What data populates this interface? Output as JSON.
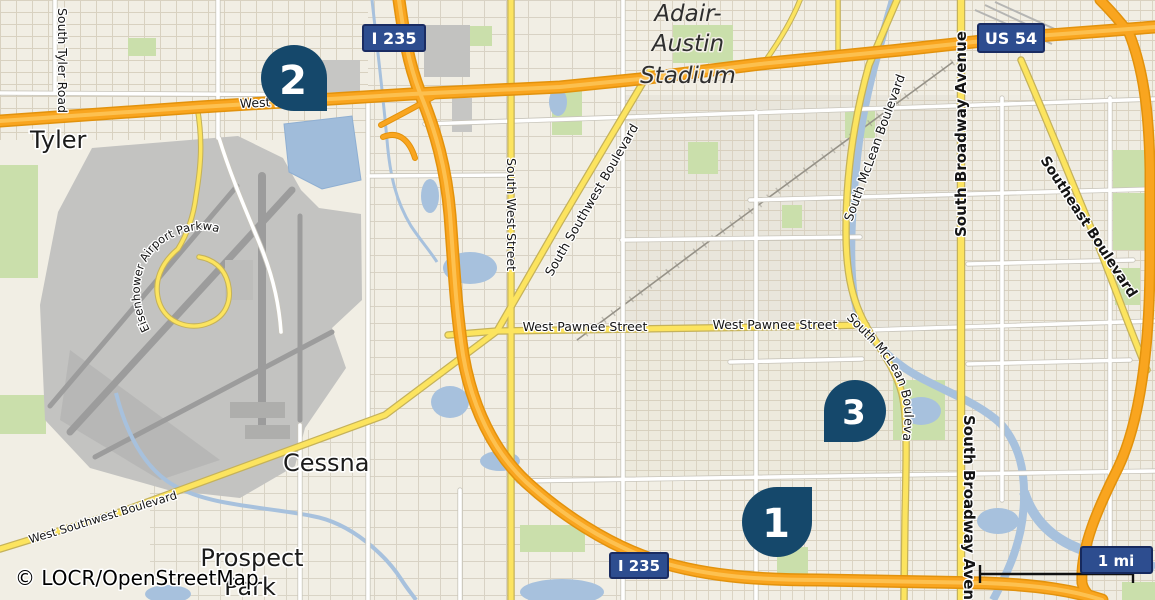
{
  "map": {
    "attribution": "© LOCR/OpenStreetMap",
    "scale_bar": {
      "label": "1 mi"
    },
    "colors": {
      "marker": "#15486b",
      "shield": "#2d4d8f",
      "shield_border": "#1a2c62",
      "motorway": "#f9a51f",
      "primary_road": "#fce45f",
      "water": "#a7c1dd",
      "park": "#cadfab",
      "background": "#f1eee4",
      "airport": "#c3c3c1"
    },
    "markers": [
      {
        "number": "1"
      },
      {
        "number": "2"
      },
      {
        "number": "3"
      }
    ],
    "shields": [
      {
        "label": "I 235"
      },
      {
        "label": "US 54"
      },
      {
        "label": "I 235"
      }
    ],
    "places": {
      "tyler": "Tyler",
      "cessna": "Cessna",
      "prospect_park": [
        "Prospect",
        "Park"
      ],
      "stadium": [
        "Adair-",
        "Austin",
        "Stadium"
      ]
    },
    "streets": {
      "south_tyler_road": "South Tyler Road",
      "west_kellogg": "West Kellogg",
      "south_west_street": "South West Street",
      "south_southwest_boulevard": "South Southwest Boulevard",
      "west_pawnee_street": "West Pawnee Street",
      "south_mclean_boulevard": "South McLean Boulevard",
      "south_broadway_avenue": "South Broadway Avenue",
      "southeast_boulevard": "Southeast Boulevard",
      "west_southwest_boulevard": "West Southwest Boulevard",
      "eisenhower_airport_parkway": "Eisenhower Airport Parkway"
    }
  }
}
